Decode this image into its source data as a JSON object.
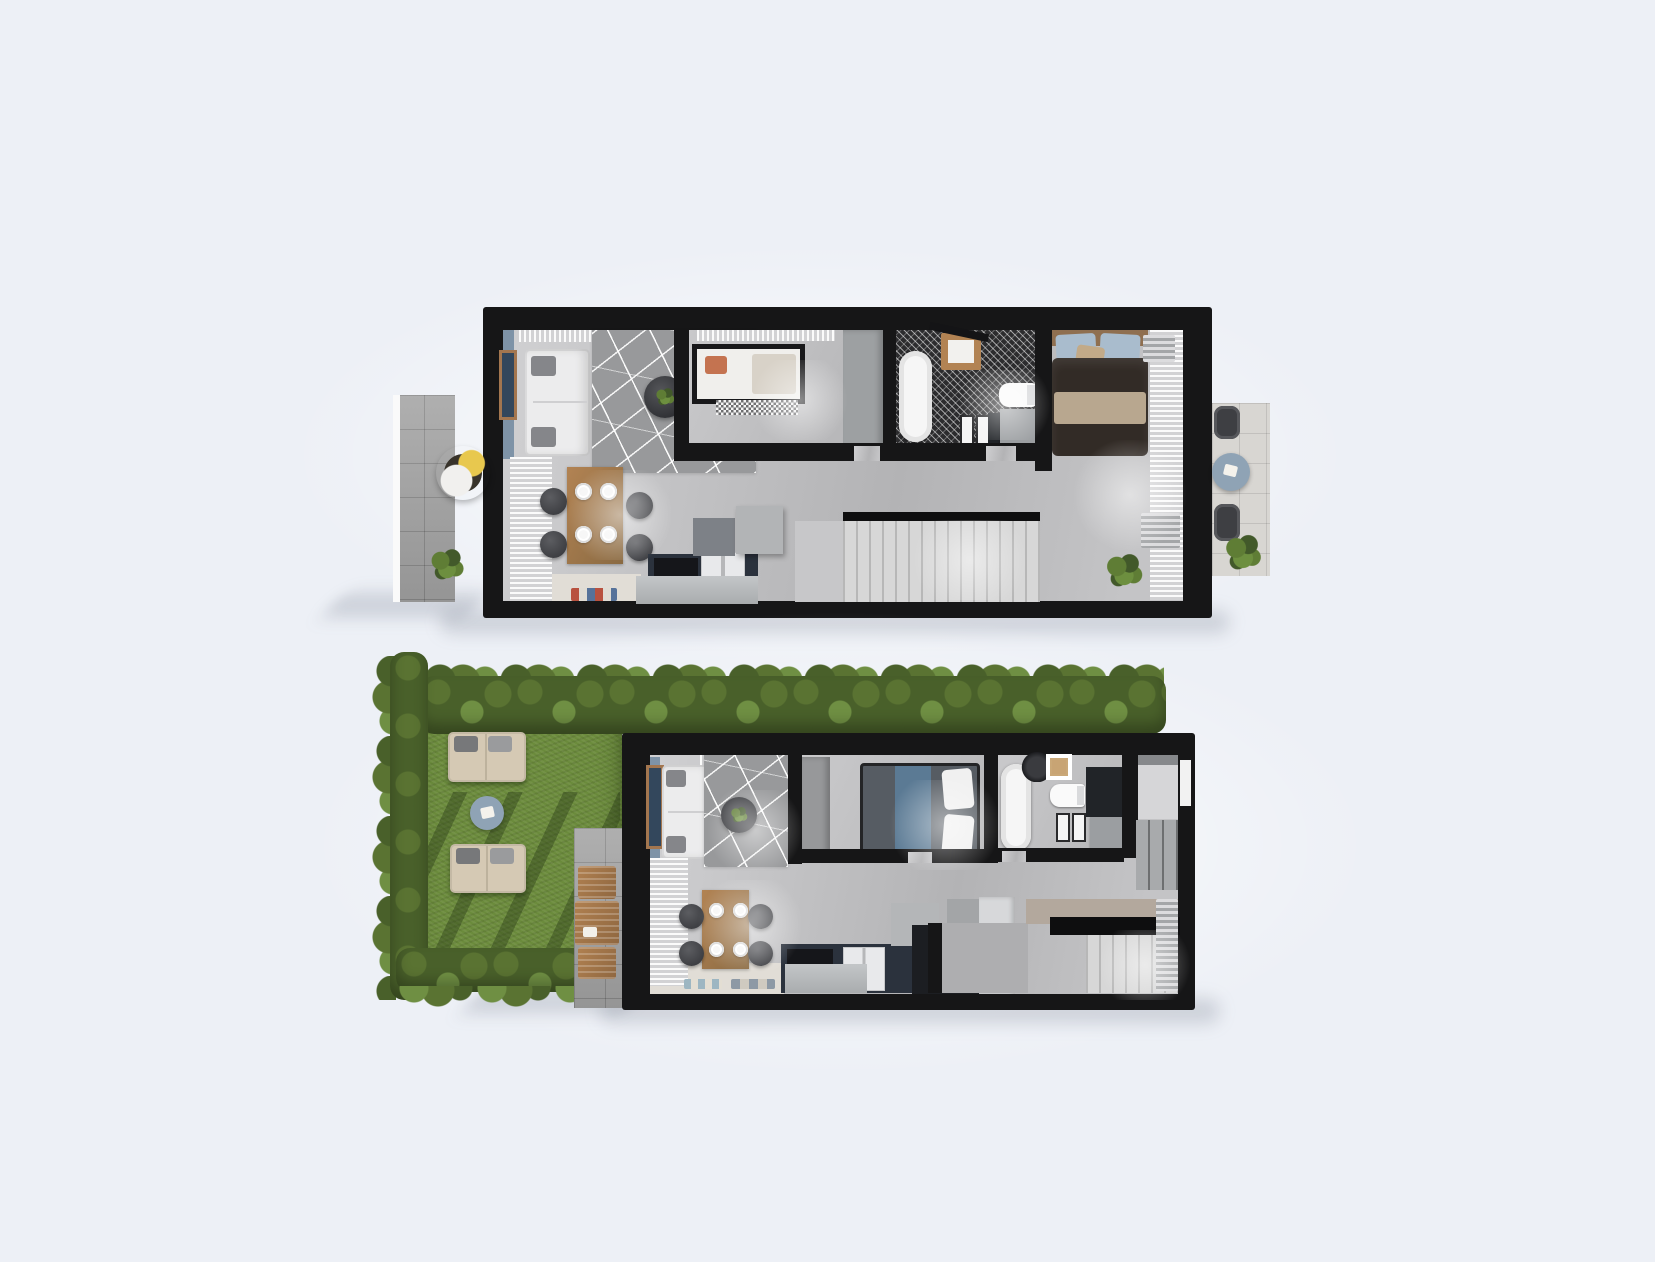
{
  "image_type": "architectural-3d-floor-plan-render",
  "text_content": "none-visible",
  "floors": [
    {
      "id": "upper-floor-plan",
      "outdoor": [
        {
          "name": "balcony-left",
          "items": [
            "hanging-egg-chair",
            "yellow-cushion",
            "potted-plant",
            "stone-tiles"
          ]
        },
        {
          "name": "balcony-right",
          "items": [
            "round-bistro-table",
            "two-wicker-chairs",
            "potted-plant",
            "stone-tiles"
          ]
        }
      ],
      "rooms": [
        {
          "name": "living-dining-kitchen",
          "items": [
            "blue-accent-wall",
            "wall-art",
            "sofa",
            "area-rug",
            "round-coffee-table",
            "dining-table",
            "four-chairs",
            "four-place-settings",
            "kitchen-counter",
            "cooktop",
            "fridge",
            "kitchen-island",
            "window-blinds",
            "doormat"
          ]
        },
        {
          "name": "kids-bedroom",
          "items": [
            "canopy-bed",
            "orange-pillow",
            "pale-blanket",
            "checkered-mat",
            "wardrobe-column"
          ]
        },
        {
          "name": "bathroom",
          "items": [
            "freestanding-bathtub",
            "shower-tray",
            "shower-bar",
            "toilet",
            "vanity",
            "mosaic-tile-floor"
          ]
        },
        {
          "name": "master-bedroom",
          "items": [
            "double-bed",
            "blue-pillows",
            "dark-duvet",
            "beige-throw",
            "curtain-wall",
            "radiators",
            "plant"
          ]
        },
        {
          "name": "hallway-stairs",
          "items": [
            "staircase",
            "black-handrail",
            "landing"
          ]
        }
      ]
    },
    {
      "id": "ground-floor-plan",
      "outdoor": [
        {
          "name": "garden",
          "items": [
            "hedge-rows",
            "lawn",
            "two-loungers",
            "round-side-table",
            "tree-shadows"
          ]
        },
        {
          "name": "patio",
          "items": [
            "wooden-folding-table",
            "two-wooden-chairs",
            "stone-tiles"
          ]
        }
      ],
      "rooms": [
        {
          "name": "living-dining-kitchen",
          "items": [
            "blue-accent-wall",
            "wall-art",
            "sofa",
            "area-rug",
            "round-coffee-table",
            "dining-table",
            "four-chairs",
            "four-place-settings",
            "kitchen-counter",
            "cooktop",
            "fridge",
            "kitchen-island",
            "tall-cabinet-unit",
            "window-blinds",
            "two-doormats"
          ]
        },
        {
          "name": "bedroom",
          "items": [
            "double-bed",
            "blue-runner",
            "white-pillows",
            "wardrobe"
          ]
        },
        {
          "name": "bathroom",
          "items": [
            "freestanding-bathtub",
            "toilet",
            "vanity",
            "desk-chair",
            "wood-frame",
            "framed-panels"
          ]
        },
        {
          "name": "utility-room",
          "items": [
            "shelving",
            "window"
          ]
        },
        {
          "name": "entry-hall-stairs",
          "items": [
            "staircase",
            "black-handrail",
            "taupe-landing",
            "radiator",
            "hall-wardrobe"
          ]
        }
      ]
    }
  ],
  "palette": {
    "bg": "#edf0f6",
    "wall": "#161617",
    "floor-a": "#d0d0d2",
    "floor-b": "#b3b3b5",
    "floor-hall": "#e1ddd6",
    "accent-wall": "#7e93a7",
    "art-frame": "#a3764f",
    "art-canvas": "#33475c",
    "sofa": "#ececed",
    "pillow-gray": "#85868a",
    "rug": "#98999b",
    "curtain-a": "#fbfbfb",
    "curtain-b": "#d2d2d4",
    "stone": "#a6a6a6",
    "stone-light": "#d8d6d2",
    "mosaic": "#2c2c2e",
    "navy": "#2b323d",
    "black-appliance": "#15161a",
    "white-appliance": "#e8e9eb",
    "island": "#c3c6c8",
    "wood-a": "#b28353",
    "wood-b": "#8a6a42",
    "chair": "#3e3f43",
    "plate": "#f6f6f6",
    "tub": "#f6f6f6",
    "vanity-gray": "#9b9ea1",
    "vanity-dark": "#212428",
    "stairs": "#d7d7d7",
    "stair-line": "rgba(0,0,0,0.15)",
    "rail": "#0e0e0f",
    "duvet-dark": "#322b26",
    "throw": "#b8a78f",
    "pillow-blue": "#a9bccd",
    "pillow-tan": "#c2aa88",
    "headboard": "#8f6f50",
    "kid-pillow": "#c47350",
    "kid-blanket": "#d8d2c8",
    "duvet-gray": "#565c63",
    "runner-blue": "#5b7a94",
    "pillow-white": "#f0f0f0",
    "wardrobe": "#97989a",
    "grass": "#6b8b3c",
    "grass-shadow": "rgba(28,44,14,0.35)",
    "hedge-a": "#5a7332",
    "hedge-b": "#49602a",
    "hedge-c": "#6f8f43",
    "lounger": "#d5c9b4",
    "lounger-pillow": "#77787a",
    "table-blue": "#8fa3b5",
    "plant-a": "#5f7d35",
    "plant-b": "#42592a",
    "patio-wood": "#b08050",
    "shadow": "rgba(96,106,124,0.22)",
    "radiator-a": "#dcdcde",
    "radiator-b": "#a4a6a8",
    "egg-dark": "#38332b",
    "egg-pillow": "#e8c84e"
  }
}
